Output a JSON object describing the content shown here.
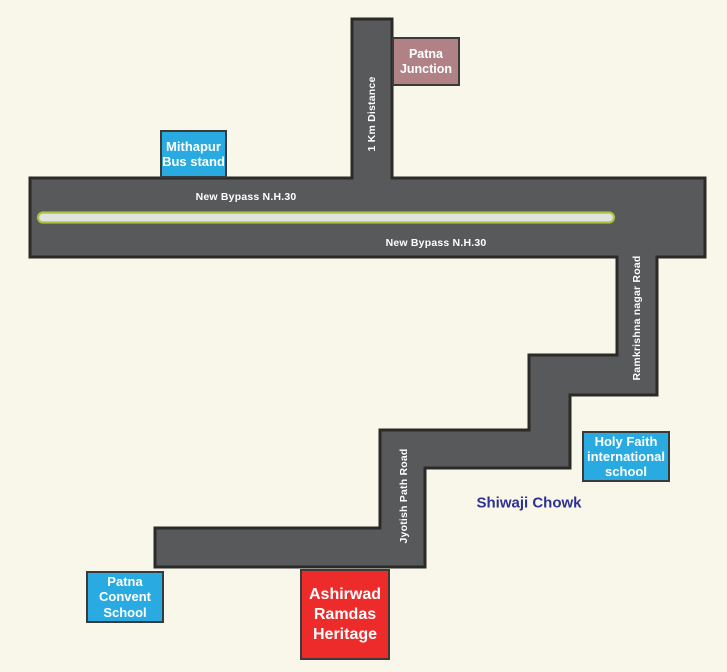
{
  "colors": {
    "background": "#F8F7EA",
    "road_fill": "#58595B",
    "road_border": "#2B2A28",
    "median_fill": "#E2E2DE",
    "median_stroke": "#A9C23F",
    "landmark_cyan": "#29ABE2",
    "landmark_red": "#ED2B2B",
    "landmark_mauve": "#B08285",
    "box_border": "#3A3A3A",
    "road_label_text": "#FFFFFF",
    "chowk_text": "#2E3192"
  },
  "roads": {
    "bypass_label_top": "New Bypass N.H.30",
    "bypass_label_bottom": "New Bypass N.H.30",
    "km_distance_label": "1 Km Distance",
    "ramkrishna_label": "Ramkrishna nagar Road",
    "jyotish_label": "Jyotish Path Road"
  },
  "landmarks": {
    "patna_junction": {
      "lines": [
        "Patna",
        "Junction"
      ]
    },
    "mithapur_bus_stand": {
      "lines": [
        "Mithapur",
        "Bus stand"
      ]
    },
    "holy_faith_school": {
      "lines": [
        "Holy Faith",
        "international",
        "school"
      ]
    },
    "shiwaji_chowk": {
      "label": "Shiwaji Chowk"
    },
    "patna_convent_school": {
      "lines": [
        "Patna",
        "Convent",
        "School"
      ]
    },
    "ashirwad_ramdas_heritage": {
      "lines": [
        "Ashirwad",
        "Ramdas",
        "Heritage"
      ]
    }
  }
}
